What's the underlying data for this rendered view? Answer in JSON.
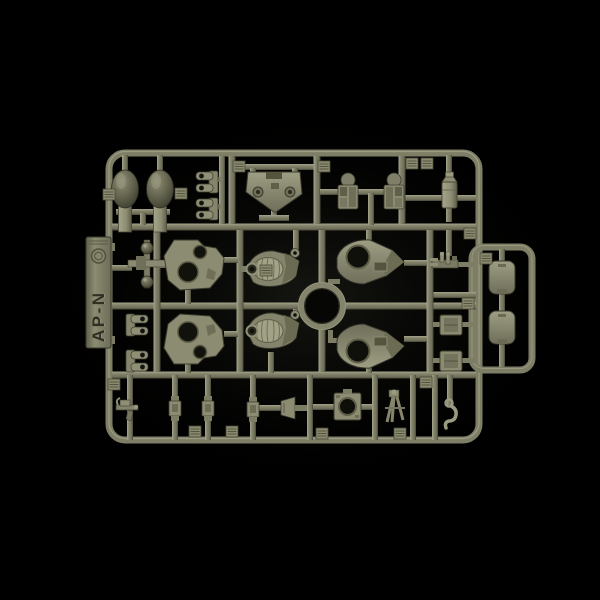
{
  "scene": {
    "description": "Studio photograph of an olive-drab injection-molded model kit sprue (parts tree) centered on a black background",
    "background_color": "#000000",
    "object": "plastic model kit sprue"
  },
  "sprue": {
    "tab_label": "AP-N",
    "tab_position": "left edge, vertical text reading upward",
    "mold_mark": "circular emblem above tab label",
    "plastic_color_name": "olive drab green",
    "center_feature": "open circular ring at central runner crossing",
    "colors": {
      "runner_highlight": "#a6a68b",
      "runner_base": "#80806a",
      "runner_shadow": "#454535",
      "part_face": "#9e9e84",
      "recess": "#12120d"
    }
  },
  "parts_inventory": [
    {
      "name": "dome-tank",
      "count": 2,
      "area": "top-left"
    },
    {
      "name": "u-clevis-bracket",
      "count": 4,
      "area": "top-left and mid-left"
    },
    {
      "name": "glacis-plate",
      "count": 1,
      "area": "top-center"
    },
    {
      "name": "bogie-assembly",
      "count": 2,
      "area": "top-center-right"
    },
    {
      "name": "canister",
      "count": 1,
      "area": "top-right"
    },
    {
      "name": "ball-joint-axle",
      "count": 1,
      "area": "mid-left"
    },
    {
      "name": "hull-side-plate",
      "count": 2,
      "area": "mid-left"
    },
    {
      "name": "ribbed-cover-shell",
      "count": 2,
      "area": "mid-center"
    },
    {
      "name": "pointed-turret-shell",
      "count": 2,
      "area": "mid-right"
    },
    {
      "name": "machine-gun-detail",
      "count": 1,
      "area": "right-column"
    },
    {
      "name": "fitting-block",
      "count": 2,
      "area": "right-column"
    },
    {
      "name": "hatch-panel",
      "count": 2,
      "area": "right-extension"
    },
    {
      "name": "pistol-grip-detail",
      "count": 1,
      "area": "bottom-left"
    },
    {
      "name": "connector-block",
      "count": 3,
      "area": "bottom-center"
    },
    {
      "name": "funnel-bracket",
      "count": 1,
      "area": "bottom-center"
    },
    {
      "name": "ported-plate",
      "count": 1,
      "area": "bottom-center"
    },
    {
      "name": "tripod-mount",
      "count": 1,
      "area": "bottom-right"
    },
    {
      "name": "tow-hook",
      "count": 1,
      "area": "bottom-right"
    },
    {
      "name": "part-number-tag",
      "count": 16,
      "area": "scattered on runners"
    }
  ]
}
